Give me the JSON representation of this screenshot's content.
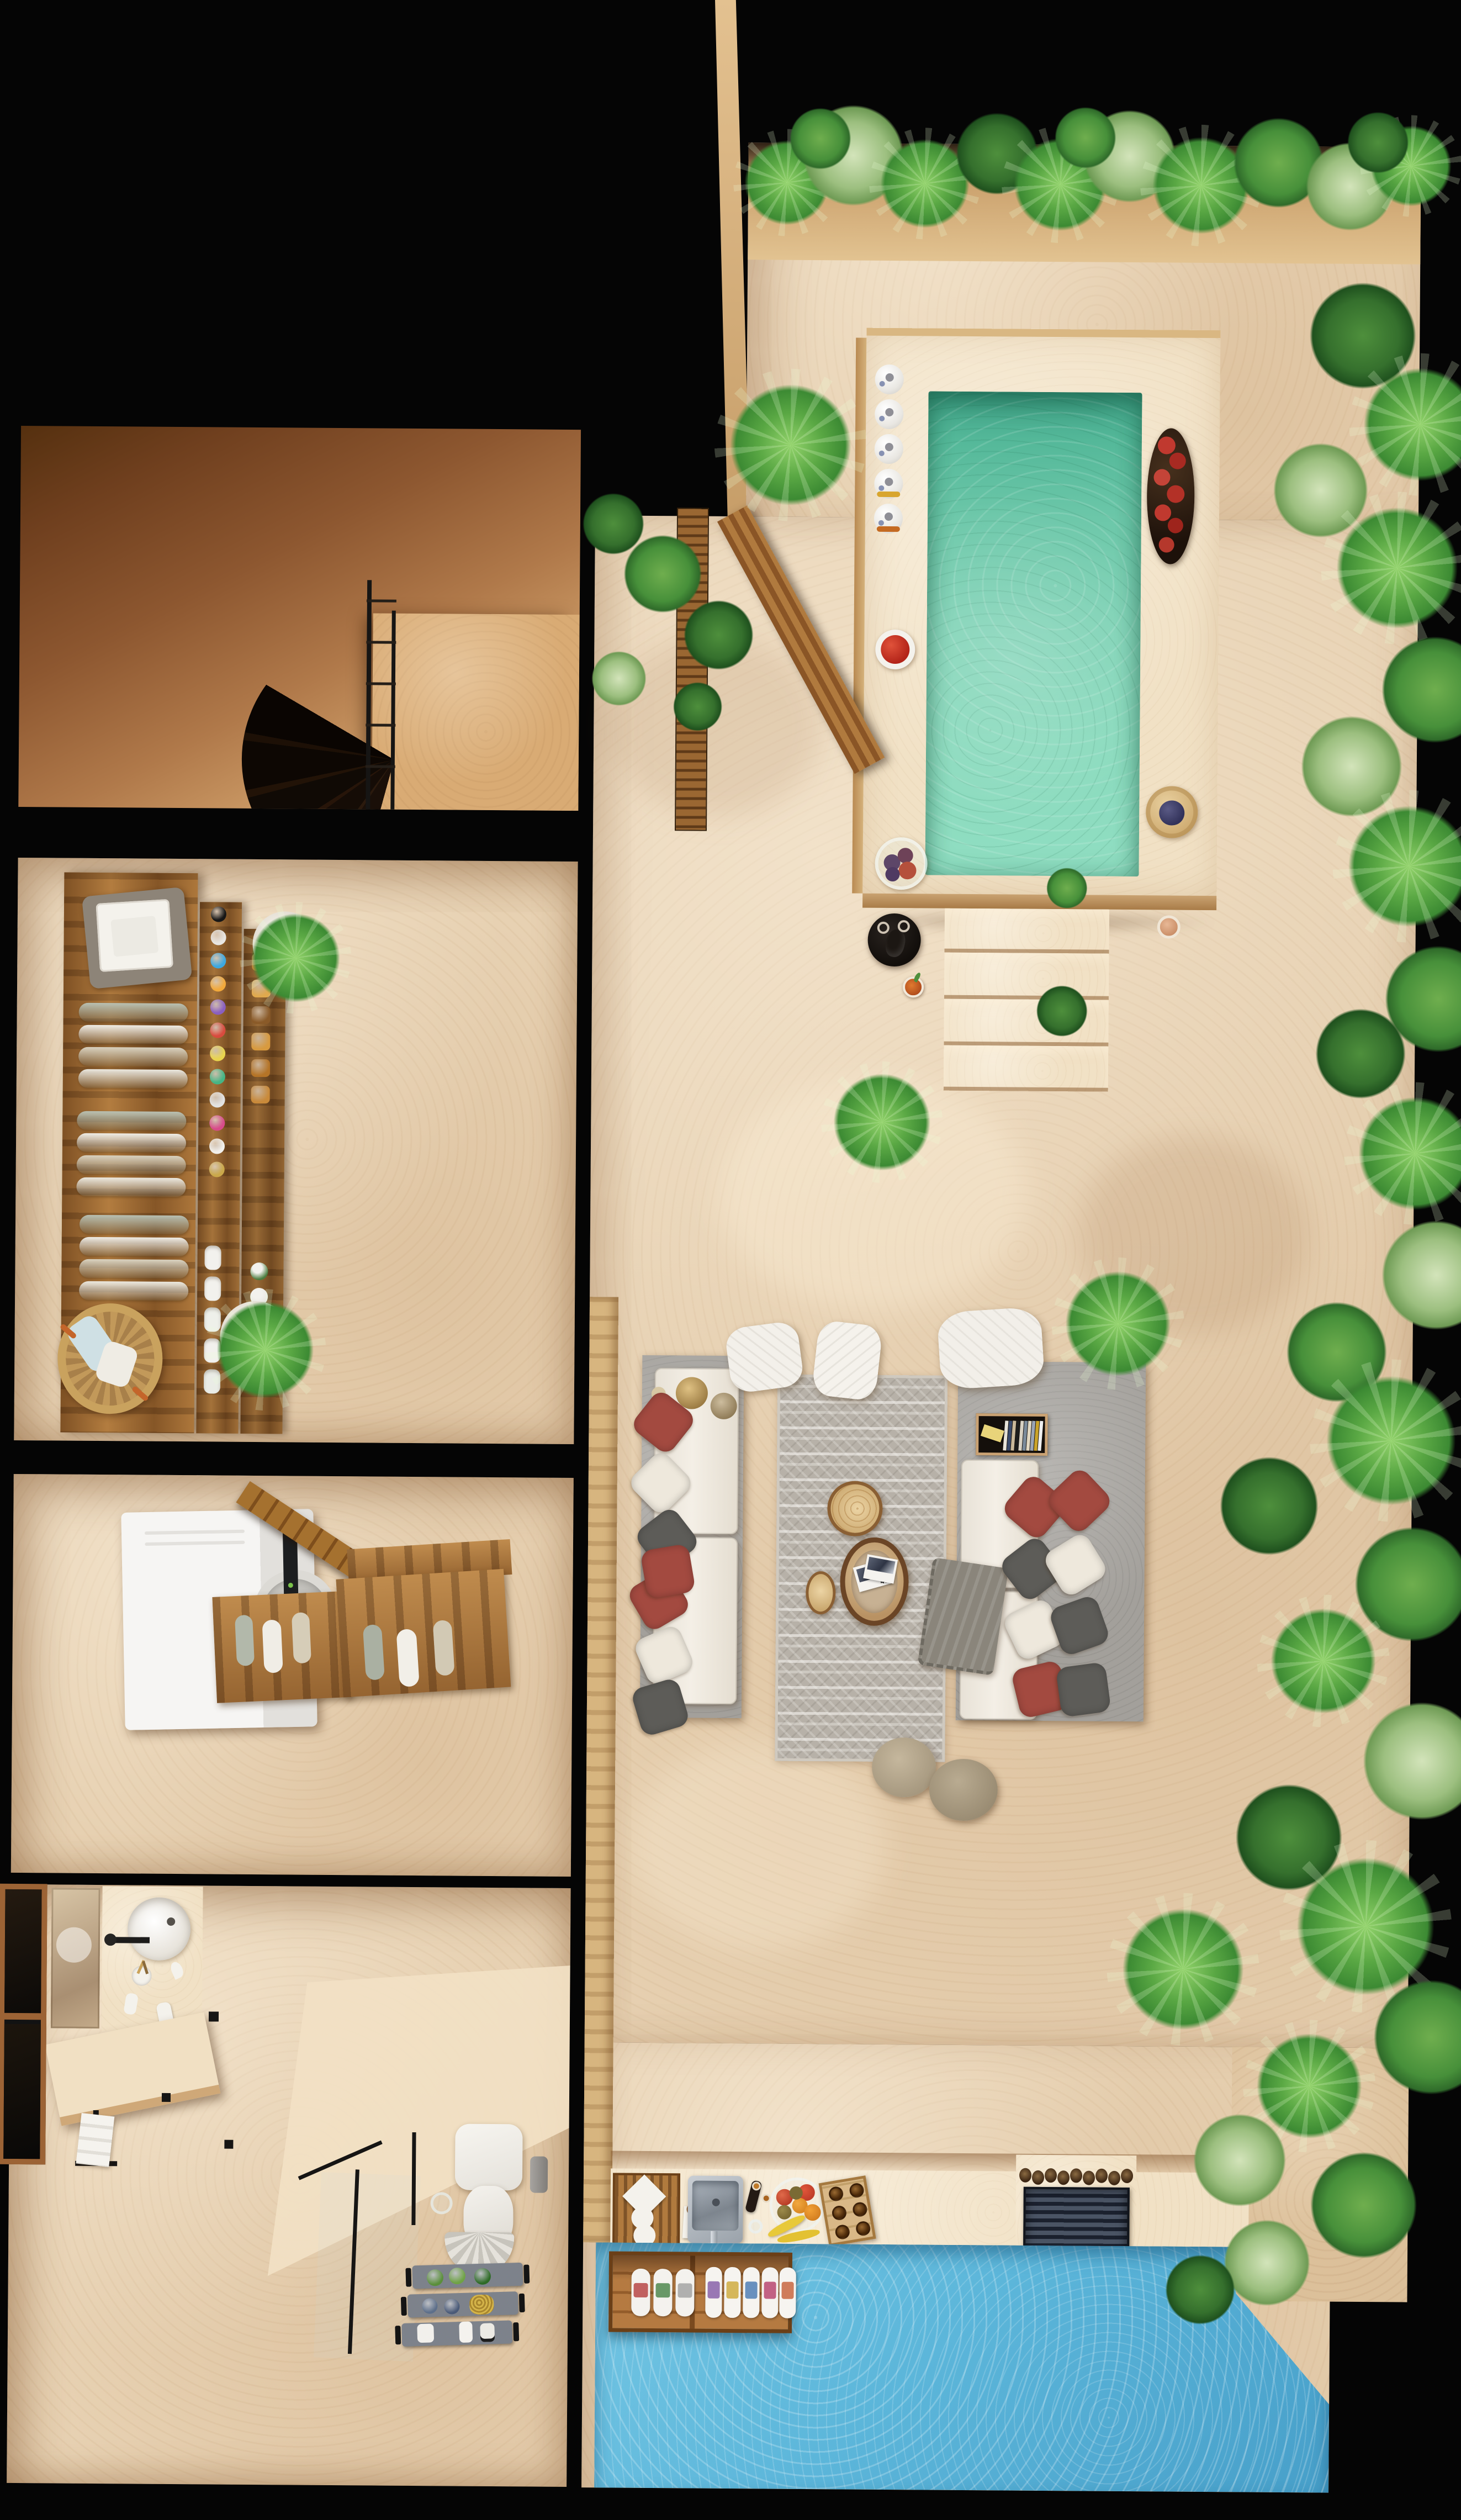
{
  "scene": {
    "type": "3d-floor-plan-top-view",
    "background": "#040404",
    "magazine_number": "49"
  },
  "palette": {
    "wall_black": "#060606",
    "floor_tan": "#e7d1b2",
    "floor_light": "#f1e1c5",
    "floor_shadow": "#b98a5e",
    "wood": "#a26c33",
    "wood_light": "#d7b57f",
    "pool_teal": "#74ceae",
    "pool_teal_dark": "#41a98b",
    "water_blue": "#5ab4d8",
    "leaf_green": "#4e9140",
    "leaf_dark": "#2f6b2a",
    "leaf_pale": "#cfe2b8",
    "concrete_grey": "#a3a09b",
    "cushion_white": "#f4efe6",
    "pillow_red": "#a34a40",
    "pillow_grey": "#5d5c58",
    "rug_grey": "#b7b1a8"
  },
  "rooms": {
    "stairwell": {
      "label": "Stairwell with spiral staircase"
    },
    "dressing": {
      "label": "Dressing room with minibar console"
    },
    "laundry": {
      "label": "Laundry room"
    },
    "bathroom": {
      "label": "Bathroom"
    },
    "terrace": {
      "label": "Terrace"
    },
    "pool_deck": {
      "label": "Plunge-pool deck"
    },
    "lounge": {
      "label": "Outdoor lounge"
    },
    "bar": {
      "label": "Outdoor bar counter"
    },
    "water_deck": {
      "label": "Blue water deck"
    }
  },
  "objects": {
    "spiral_stairs": {
      "label": "Spiral staircase"
    },
    "console": {
      "label": "Wood console with towels and minibar"
    },
    "towel_tray": {
      "label": "Tray with folded towels"
    },
    "basket": {
      "label": "Rattan basket with pillows"
    },
    "washer": {
      "label": "Washing machine"
    },
    "towel_bench": {
      "label": "Wood bench with rolled towels"
    },
    "window": {
      "label": "Wood-frame window"
    },
    "mirror": {
      "label": "Vanity mirror"
    },
    "sink": {
      "label": "Round vessel sink"
    },
    "vanity": {
      "label": "Floating stone vanity"
    },
    "shower": {
      "label": "Glass shower enclosure"
    },
    "toilet": {
      "label": "Toilet"
    },
    "amenity_rack": {
      "label": "Bath amenity rack"
    },
    "plunge_pool": {
      "label": "Plunge pool"
    },
    "pool_steps": {
      "label": "Deck steps"
    },
    "wine_tray": {
      "label": "Black tray with decanter"
    },
    "fruit_plate": {
      "label": "Strawberry plate"
    },
    "fruit_bowl_glass": {
      "label": "Glass fruit bowl"
    },
    "pomegranate_tray": {
      "label": "Tray with pomegranates"
    },
    "berry_board": {
      "label": "Board with blueberries"
    },
    "sofa_left": {
      "label": "Lounge sofa (left)"
    },
    "sofa_right": {
      "label": "Lounge sofa (right)"
    },
    "rug": {
      "label": "Patterned outdoor rug"
    },
    "coffee_tables": {
      "label": "Log-slice coffee tables"
    },
    "poufs": {
      "label": "White poufs"
    },
    "ottomans": {
      "label": "Round ottomans"
    },
    "bar_sink": {
      "label": "Outdoor bar sink"
    },
    "dish_rack": {
      "label": "Dish rack"
    },
    "bar_fruit_bowl": {
      "label": "Fruit bowl"
    },
    "beer_crate": {
      "label": "Bottle crate"
    },
    "grill": {
      "label": "Slatted fire grill"
    },
    "drink_caddy": {
      "label": "Floating drink caddy"
    },
    "screen_door": {
      "label": "Wood slat screen and open door"
    }
  }
}
